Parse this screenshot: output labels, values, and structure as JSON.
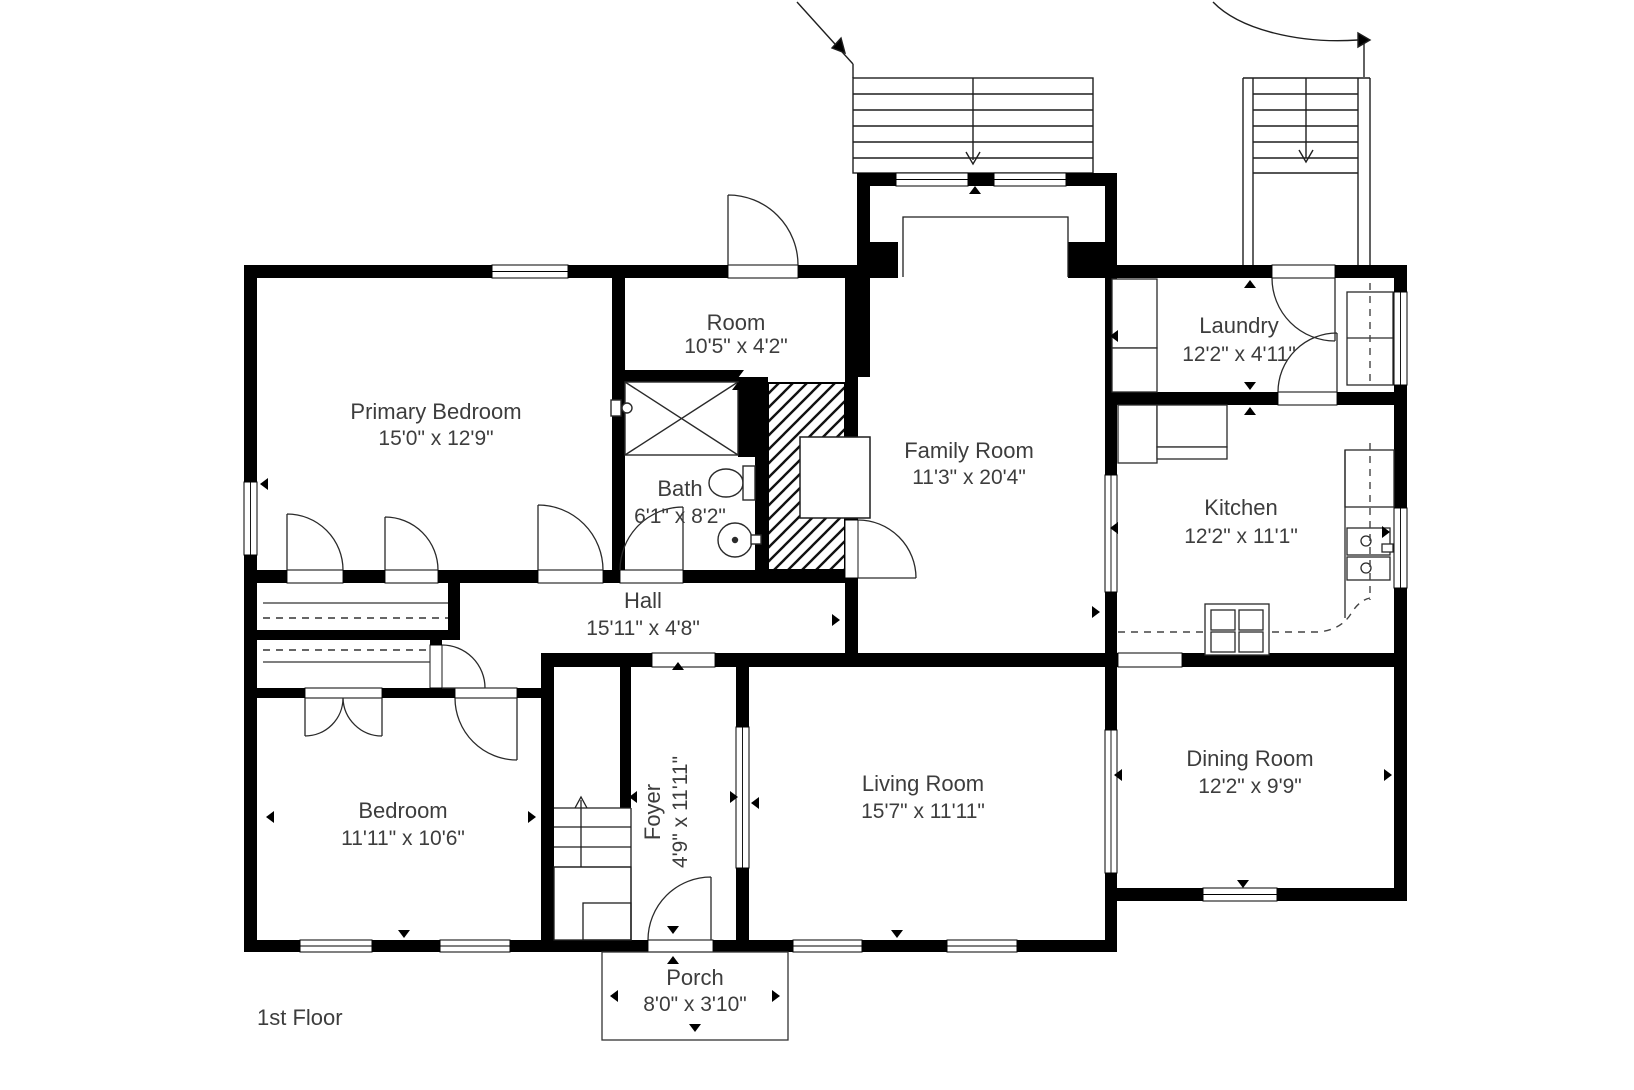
{
  "floor_label": "1st Floor",
  "rooms": {
    "primary_bedroom": {
      "name": "Primary Bedroom",
      "dims": "15'0\" x 12'9\""
    },
    "room": {
      "name": "Room",
      "dims": "10'5\" x 4'2\""
    },
    "bath": {
      "name": "Bath",
      "dims": "6'1\" x 8'2\""
    },
    "family_room": {
      "name": "Family Room",
      "dims": "11'3\" x 20'4\""
    },
    "laundry": {
      "name": "Laundry",
      "dims": "12'2\" x 4'11\""
    },
    "kitchen": {
      "name": "Kitchen",
      "dims": "12'2\" x 11'1\""
    },
    "hall": {
      "name": "Hall",
      "dims": "15'11\" x 4'8\""
    },
    "bedroom": {
      "name": "Bedroom",
      "dims": "11'11\" x 10'6\""
    },
    "foyer": {
      "name": "Foyer",
      "dims": "4'9\" x 11'11\""
    },
    "living_room": {
      "name": "Living Room",
      "dims": "15'7\" x 11'11\""
    },
    "dining_room": {
      "name": "Dining Room",
      "dims": "12'2\" x 9'9\""
    },
    "porch": {
      "name": "Porch",
      "dims": "8'0\" x 3'10\""
    }
  },
  "colors": {
    "wall": "#000000",
    "line": "#1f1f1f",
    "text": "#3d3d3d",
    "background": "#ffffff"
  }
}
